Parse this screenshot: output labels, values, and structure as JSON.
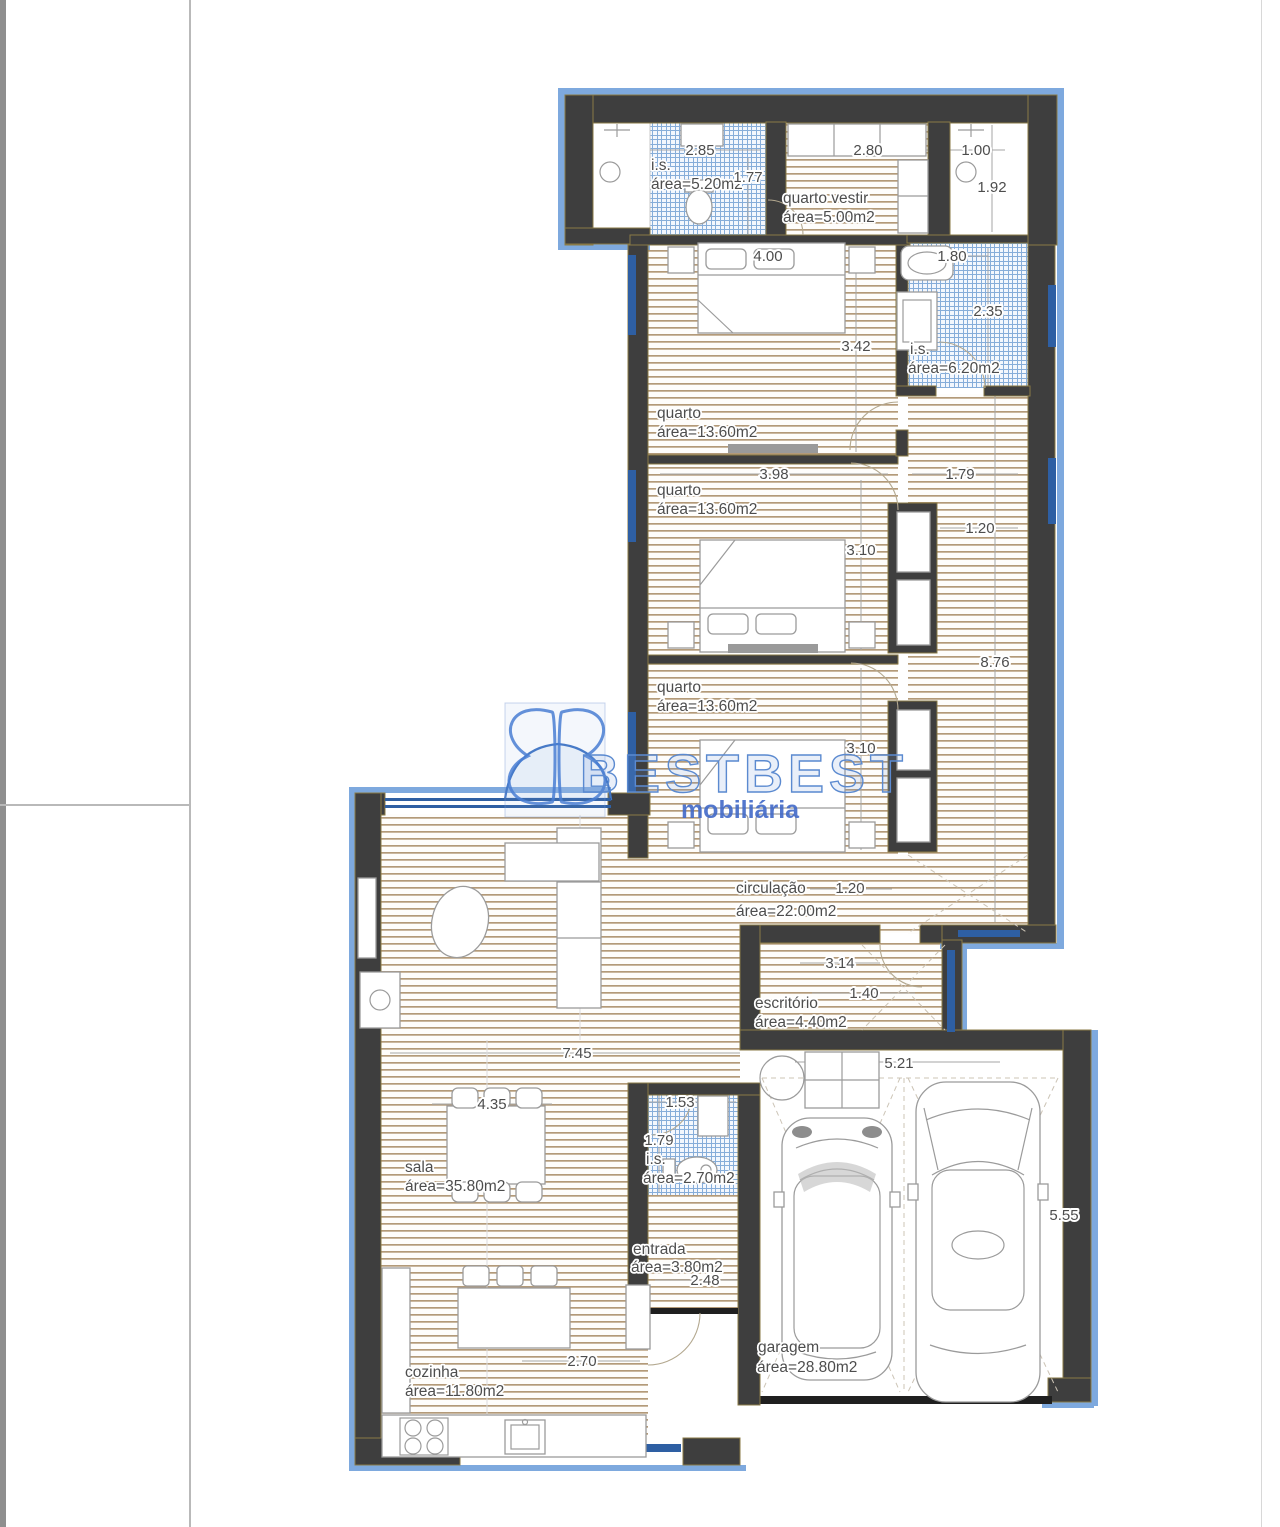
{
  "watermark": {
    "brand": "BESTBEST",
    "subtitle": "mobiliária"
  },
  "colors": {
    "brand": "#5b8ad0",
    "brand_solid": "#4169c8",
    "wall": "#3e3e3e",
    "wall_accent": "#8a7a45",
    "window_blue": "#2e5fa3",
    "exterior_band": "#7ea9de",
    "wood_line": "#b39a79",
    "tile_blue": "#86add9",
    "text": "#4d4d4d"
  },
  "rooms": {
    "is_520": {
      "name": "i.s.",
      "area": "área=5.20m2"
    },
    "quarto_vestir": {
      "name": "quarto vestir",
      "area": "área=5.00m2"
    },
    "is_620": {
      "name": "i.s.",
      "area": "área=6.20m2"
    },
    "quarto_1": {
      "name": "quarto",
      "area": "área=13.60m2"
    },
    "quarto_2": {
      "name": "quarto",
      "area": "área=13.60m2"
    },
    "quarto_3": {
      "name": "quarto",
      "area": "área=13.60m2"
    },
    "circulacao": {
      "name": "circulação",
      "area": "área=22.00m2"
    },
    "escritorio": {
      "name": "escritório",
      "area": "área=4.40m2"
    },
    "is_270": {
      "name": "i.s.",
      "area": "área=2.70m2"
    },
    "sala": {
      "name": "sala",
      "area": "área=35.80m2"
    },
    "entrada": {
      "name": "entrada",
      "area": "área=3.80m2"
    },
    "cozinha": {
      "name": "cozinha",
      "area": "área=11.80m2"
    },
    "garagem": {
      "name": "garagem",
      "area": "área=28.80m2"
    }
  },
  "dims": {
    "is520_w": "2.85",
    "vestir_w": "2.80",
    "shower_w": "1.00",
    "is520_door": "1.77",
    "shower_h": "1.92",
    "q1_bed_w": "4.00",
    "is620_w": "1.80",
    "q1_h": "3.42",
    "is620_h": "2.35",
    "q2_w": "3.98",
    "corr_top_w": "1.79",
    "ward_door": "1.20",
    "q2_bed_h": "3.10",
    "corr_h": "8.76",
    "q3_bed_h": "3.10",
    "circ_w": "1.20",
    "circ_len": "3.14",
    "esc_h": "1.40",
    "sala_w": "7.45",
    "gar_w": "5.21",
    "mesa_w": "4.35",
    "is270_w": "1.53",
    "is270_h": "1.79",
    "ent_w": "2.48",
    "coz_w": "2.70",
    "gar_h": "5.55"
  }
}
